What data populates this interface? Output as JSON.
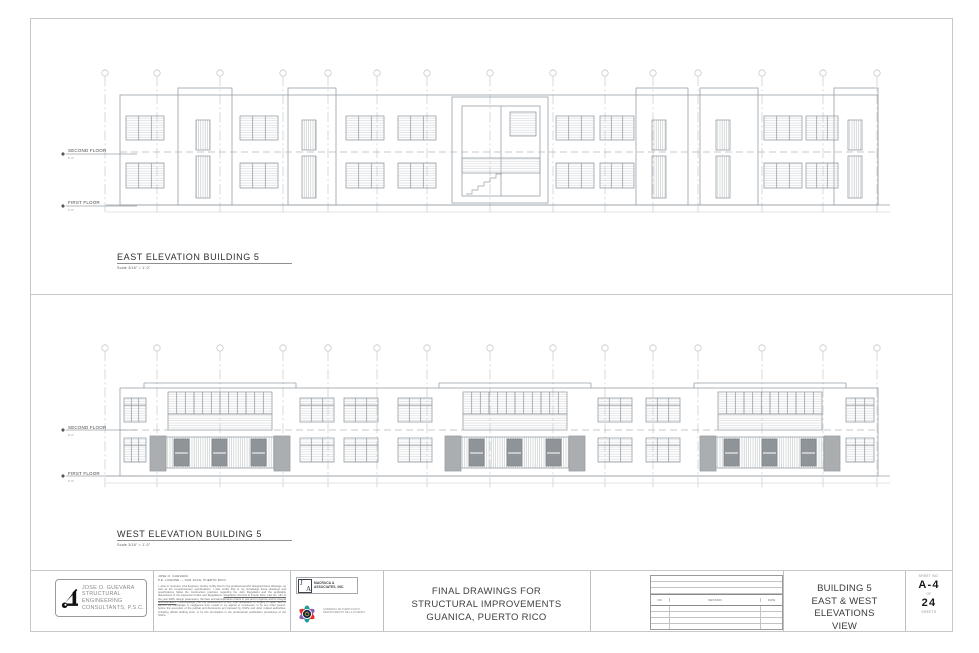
{
  "east": {
    "title": "EAST ELEVATION BUILDING 5",
    "scale": "Scale 3/16\" = 1'-0\"",
    "labels": {
      "second": "SECOND FLOOR",
      "second_elev": "9'-0\"",
      "first": "FIRST FLOOR",
      "first_elev": "0'-0\""
    }
  },
  "west": {
    "title": "WEST ELEVATION BUILDING 5",
    "scale": "Scale 3/16\" = 1'-0\"",
    "labels": {
      "second": "SECOND FLOOR",
      "second_elev": "9'-0\"",
      "first": "FIRST FLOOR",
      "first_elev": "0'-0\""
    }
  },
  "titleblock": {
    "engineer": {
      "line1": "JOSE O. GUEVARA",
      "line2": "STRUCTURAL",
      "line3": "ENGINEERING",
      "line4": "CONSULTANTS, P.S.C."
    },
    "fineprint": {
      "head1": "JOSE O. GUEVARA",
      "head2": "P.E. LICENSE — SAN JUAN, PUERTO RICO",
      "para1": "I, Jose O. Guevara, Civil Engineer, hereby certify that I'm the professional who designed these drawings, as well as the complementary specifications. I also certify that to my knowledge these drawings and specifications follow the construction practices regarding the Joint Regulation and the applicable dispositions of the Approved Codes and Regulations.",
      "para2": "Regulatory Permits of Puerto Rico, Law No. 161 of the year 2009, design parameters, the laws and administrative orders in use and in vigence and its integral documentation.",
      "para3": "I acknowledge that the development of any final declaration or forgery of facts, with or without my knowledge or negligence from myself or my agents or employees, in by any other person, before the execution of the judicial and documents act imposed by OGPe and other related authorities, including official drafting work, is by this termination in the professional certification procedures of the OGPe."
    },
    "macruca": {
      "initial_j": "J",
      "initial_a": "A",
      "name1": "MACRUCA &",
      "name2": "ASSOCIATES, INC."
    },
    "gov": {
      "line1": "GOBIERNO DE PUERTO RICO",
      "line2": "DEPARTAMENTO DE LA VIVIENDA"
    },
    "project": {
      "line1": "FINAL DRAWINGS FOR",
      "line2": "STRUCTURAL IMPROVEMENTS",
      "line3": "GUANICA, PUERTO RICO"
    },
    "revisions": {
      "no": "NO.",
      "revision": "REVISION",
      "date": "DATE"
    },
    "title": {
      "line1": "BUILDING 5",
      "line2": "EAST & WEST ELEVATIONS",
      "line3": "VIEW"
    },
    "sheet": {
      "label": "SHEET NO.",
      "number": "A-4",
      "of": "OF",
      "total": "24",
      "sheets": "SHEETS"
    }
  },
  "colors": {
    "linework": "#9aa1a6",
    "grid": "#c4c9cc",
    "dark_panel": "#8f9499",
    "logo_navy": "#1b2a4a"
  }
}
